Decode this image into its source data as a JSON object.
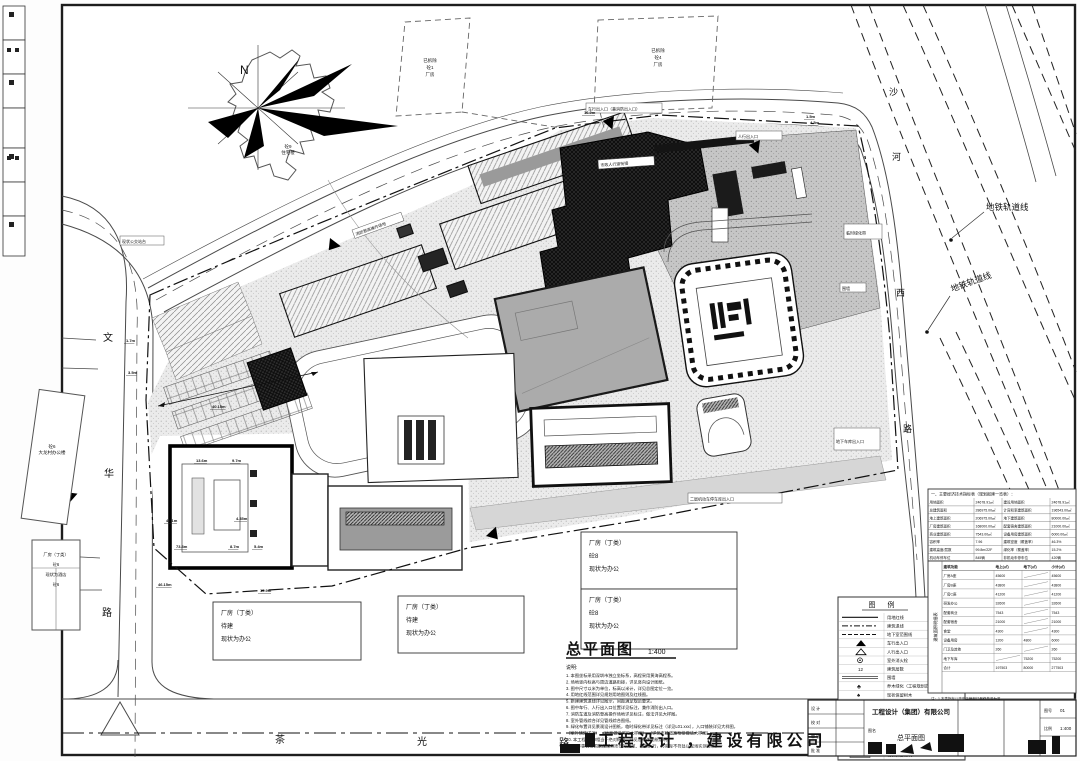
{
  "drawing": {
    "north_label": "N",
    "title": "总平面图",
    "scale": "1:400",
    "notes_heading": "说明:",
    "notes": [
      "1. 本图坐标采用深圳市独立坐标系，高程采用黄海高程系。",
      "2. 场地竖向标高与周边道路衔接，详见竖向设计图纸。",
      "3. 图中尺寸以米为单位，标高以米计，详见总图定位一览。",
      "4. 用地红线范围详见规划用地图则及红线图。",
      "5. 新建建筑退线详见图示，间距满足规范要求。",
      "6. 图中车行、人行出入口位置详见标注，兼作消防出入口。",
      "7. 消防车道及消防登高操作场地详见标注，做法详见大样图。",
      "8. 室外管线综合详见管线综合图纸。",
      "9. 绿化布置详见景观设计图纸，临时绿化带详见标注（详见L01.xxx），入口铺装详见大样图，",
      "   （室外铺装详见）     （地面做法详见大样图）              （详见市政道路衔接做法大样图）",
      "10. 本工程±0.00相当于绝对标高，详见各单体图纸说明。",
      "11. 未尽事宜按国家及深圳市现行规范、规定执行，与实际不符处以现场实测为准。"
    ]
  },
  "roads": {
    "left_vertical": "文华路",
    "bottom": "茶光路",
    "right_vertical": "沙河西路",
    "subway_label_1": "地铁轨道线",
    "subway_label_2": "地铁轨道线"
  },
  "buildings": {
    "residential": [
      "砼9",
      "住宅楼"
    ],
    "demolished_1": [
      "已拆除",
      "砼1",
      "厂房"
    ],
    "demolished_2": [
      "已拆除",
      "砼4",
      "厂房"
    ],
    "village_office": [
      "砼6",
      "大龙村办公楼"
    ],
    "hotel": [
      "厂房（丁类）",
      "砼6",
      "现状为酒店",
      "砼6"
    ],
    "label_box_1": [
      "厂房（丁类）",
      "待建",
      "现状为办公"
    ],
    "label_box_2": [
      "厂房（丁类）",
      "待建",
      "现状为办公"
    ],
    "label_box_3": [
      "厂房（丁类）",
      "砼8",
      "现状为办公"
    ],
    "label_box_4": [
      "厂房（丁类）",
      "砼8",
      "现状为办公"
    ]
  },
  "annotations": [
    "车行出入口（兼消防出入口）",
    "人行出入口",
    "市政人行道衔接",
    "临时绿化带",
    "围墙",
    "地下车库出入口",
    "二层机动车停车库出入口",
    "消防登高操作场地",
    "现状公交站台"
  ],
  "dimensions": [
    "1.7m",
    "3.5m",
    "40.15m",
    "13.6m",
    "9.7m",
    "47.1m",
    "4.35m",
    "73.8m",
    "8.7m",
    "5.4m",
    "46.15m",
    "10.9m",
    "16.9m",
    "4.5m",
    "1.5m"
  ],
  "legend": {
    "title": "图    例",
    "items": [
      {
        "icon": "solid-line",
        "label": "用地红线"
      },
      {
        "icon": "dash-dot-line",
        "label": "建筑退线"
      },
      {
        "icon": "dash-line",
        "label": "地下室范围线"
      },
      {
        "icon": "arrow-solid",
        "label": "车行出入口"
      },
      {
        "icon": "arrow-open",
        "label": "人行出入口"
      },
      {
        "icon": "hydrant",
        "label": "室外消火栓"
      },
      {
        "icon": "storey-num",
        "label": "建筑层数"
      },
      {
        "icon": "double-line",
        "label": "围墙"
      },
      {
        "icon": "tree",
        "label": "乔木绿化（工程规划范围）"
      },
      {
        "icon": "tree-existing",
        "label": "现状保留树木"
      },
      {
        "icon": "flag",
        "label": "现状迁移树木"
      },
      {
        "icon": "elevation",
        "label": "道路标高（详见竖向设计）"
      },
      {
        "icon": "elevation-solid",
        "label": "室外地坪标高"
      },
      {
        "icon": "hatch-box",
        "label": "消防登高操作场地"
      },
      {
        "icon": "dash-box",
        "label": "消防车道范围"
      },
      {
        "icon": "new-box",
        "label": "新建建筑轮廓"
      },
      {
        "icon": "old-box",
        "label": "现状保留建筑"
      }
    ]
  },
  "econ_table": {
    "header": "一、主要经济技术指标表（规划报建一览表）：",
    "rows": [
      [
        "用地面积",
        "24678.91㎡",
        "建设用地面积",
        "24678.91㎡"
      ],
      [
        "总建筑面积",
        "286975.00㎡",
        "计容积率建筑面积",
        "196543.00㎡"
      ],
      [
        "地上建筑面积",
        "206975.00㎡",
        "地下建筑面积",
        "80000.00㎡"
      ],
      [
        "厂房建筑面积",
        "168000.00㎡",
        "配套宿舍建筑面积",
        "21000.00㎡"
      ],
      [
        "商业建筑面积",
        "7543.00㎡",
        "设备用房建筑面积",
        "6000.00㎡"
      ],
      [
        "容积率",
        "7.96",
        "建筑密度（覆盖率）",
        "46.3%"
      ],
      [
        "建筑高度/层数",
        "99.8m/22F",
        "绿化率（覆盖率）",
        "15.2%"
      ],
      [
        "机动车停车位",
        "845辆",
        "非机动车停车位",
        "420辆"
      ]
    ]
  },
  "area_table": {
    "side_label": "建筑面积明细表",
    "header": [
      "建筑功能",
      "地上(㎡)",
      "地下(㎡)",
      "小计(㎡)"
    ],
    "rows": [
      [
        "厂房A座",
        "45600",
        "—",
        "45600"
      ],
      [
        "厂房B座",
        "43800",
        "—",
        "43800"
      ],
      [
        "厂房C座",
        "41200",
        "—",
        "41200"
      ],
      [
        "研发办公",
        "32600",
        "—",
        "32600"
      ],
      [
        "配套商业",
        "7543",
        "—",
        "7543"
      ],
      [
        "配套宿舍",
        "21000",
        "—",
        "21000"
      ],
      [
        "食堂",
        "4300",
        "—",
        "4300"
      ],
      [
        "设备用房",
        "1200",
        "4800",
        "6000"
      ],
      [
        "门卫及其他",
        "260",
        "—",
        "260"
      ],
      [
        "地下车库",
        "—",
        "75200",
        "75200"
      ],
      [
        "合计",
        "197503",
        "80000",
        "277503"
      ]
    ]
  },
  "small_notes": [
    "注：1.本表指标以政府主管部门最终核准为准。",
    "2.建筑面积按《建筑工程建筑面积计算规范》计算。",
    "3.停车位数量详见地下车库平面图。",
    "4.未尽事宜详见各专业图纸及说明。"
  ],
  "title_block": {
    "company": "工程设计（集团）有限公司",
    "stamp": "工程设计 ，建设有限公司",
    "sign_rows": [
      "设 计",
      "校 对",
      "审 核",
      "批 准"
    ],
    "drawing_name_label": "图名",
    "drawing_name": "总平面图",
    "number_label": "图号",
    "number": "01",
    "scale_label": "比例",
    "scale": "1:400"
  }
}
